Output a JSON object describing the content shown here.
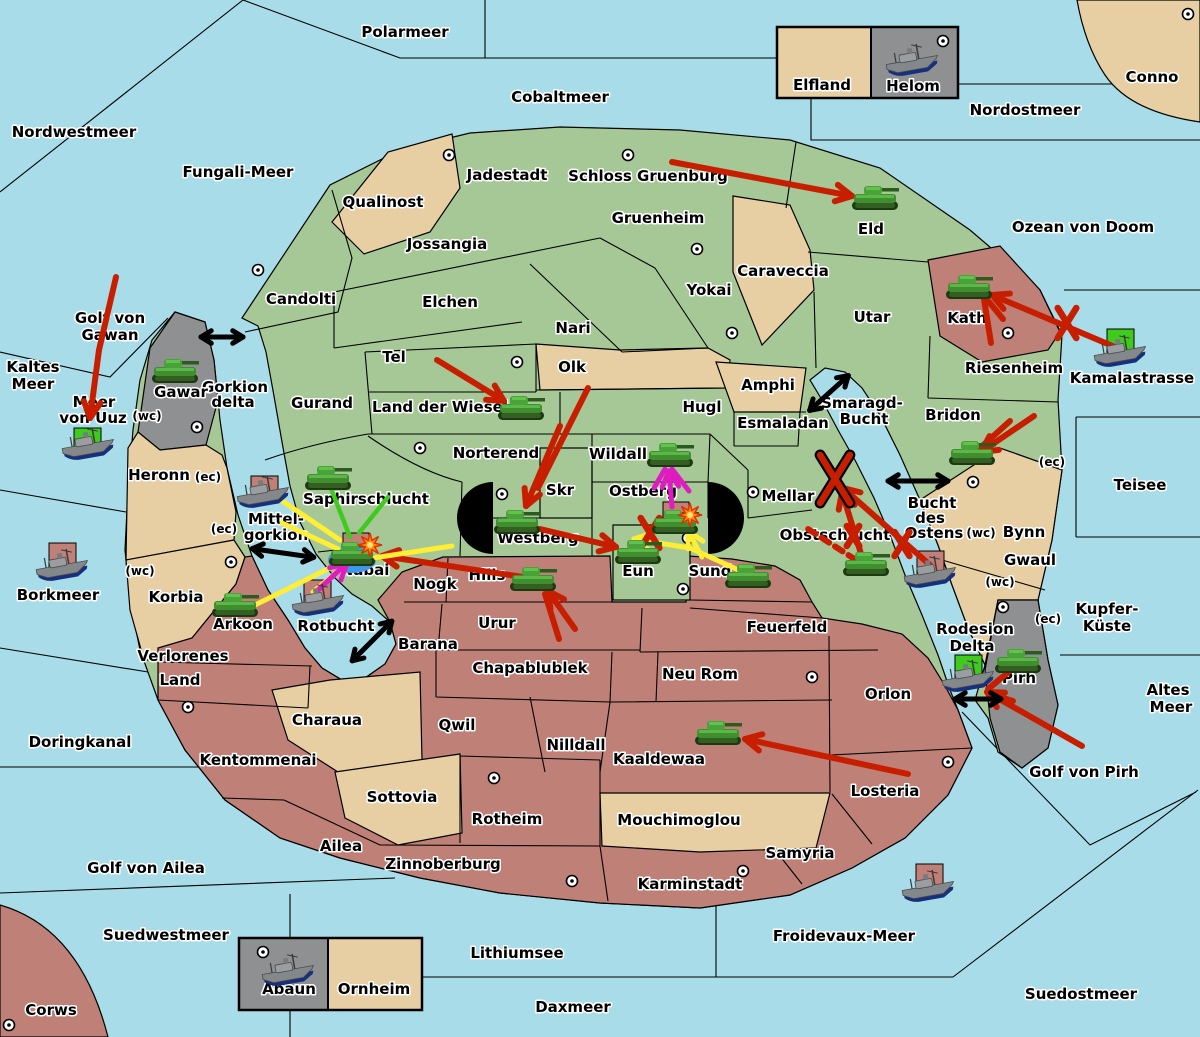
{
  "palette": {
    "sea": "#a8dce8",
    "land_green": "#a6c897",
    "land_tan": "#e7cfa3",
    "land_pink": "#bf8078",
    "land_gray": "#8f9092",
    "arrow_red": "#c81e00",
    "support_yellow": "#ffee33",
    "support_green": "#3ecb1e",
    "convoy_magenta": "#df1cc0",
    "dislodged_blue": "#3e97e8",
    "explosion_orange": "#ff9100",
    "border_black": "#000000"
  },
  "labels": [
    {
      "t": "Polarmeer",
      "x": 405,
      "y": 37
    },
    {
      "t": "Cobaltmeer",
      "x": 560,
      "y": 102
    },
    {
      "t": "Nordostmeer",
      "x": 1025,
      "y": 115
    },
    {
      "t": "Conno",
      "x": 1152,
      "y": 82
    },
    {
      "t": "Ozean von Doom",
      "x": 1083,
      "y": 232
    },
    {
      "t": "Nordwestmeer",
      "x": 74,
      "y": 137
    },
    {
      "t": "Fungali-Meer",
      "x": 238,
      "y": 177
    },
    {
      "t": "Kaltes",
      "x": 33,
      "y": 372
    },
    {
      "t": "Meer",
      "x": 33,
      "y": 389
    },
    {
      "t": "Golf von",
      "x": 110,
      "y": 323
    },
    {
      "t": "Gawan",
      "x": 110,
      "y": 340
    },
    {
      "t": "Meer",
      "x": 94,
      "y": 407
    },
    {
      "t": "von Uuz",
      "x": 93,
      "y": 423
    },
    {
      "t": "Kamalastrasse",
      "x": 1132,
      "y": 383
    },
    {
      "t": "Teisee",
      "x": 1140,
      "y": 490
    },
    {
      "t": "Borkmeer",
      "x": 58,
      "y": 600
    },
    {
      "t": "Doringkanal",
      "x": 80,
      "y": 747
    },
    {
      "t": "Golf von Ailea",
      "x": 146,
      "y": 873
    },
    {
      "t": "Suedwestmeer",
      "x": 166,
      "y": 940
    },
    {
      "t": "Lithiumsee",
      "x": 517,
      "y": 958
    },
    {
      "t": "Daxmeer",
      "x": 573,
      "y": 1012
    },
    {
      "t": "Froidevaux-Meer",
      "x": 844,
      "y": 941
    },
    {
      "t": "Suedostmeer",
      "x": 1081,
      "y": 999
    },
    {
      "t": "Golf von Pirh",
      "x": 1084,
      "y": 777
    },
    {
      "t": "Kupfer-",
      "x": 1107,
      "y": 614
    },
    {
      "t": "Küste",
      "x": 1107,
      "y": 631
    },
    {
      "t": "Altes",
      "x": 1168,
      "y": 695
    },
    {
      "t": "Meer",
      "x": 1171,
      "y": 712
    },
    {
      "t": "Corws",
      "x": 51,
      "y": 1015
    },
    {
      "t": "Smaragd-",
      "x": 862,
      "y": 408
    },
    {
      "t": "Bucht",
      "x": 864,
      "y": 424
    },
    {
      "t": "Bucht",
      "x": 932,
      "y": 508
    },
    {
      "t": "des",
      "x": 930,
      "y": 523
    },
    {
      "t": "Ostens",
      "x": 934,
      "y": 538
    },
    {
      "t": "Mittel-",
      "x": 276,
      "y": 524
    },
    {
      "t": "gorkion",
      "x": 276,
      "y": 540
    },
    {
      "t": "Gorkion",
      "x": 235,
      "y": 392
    },
    {
      "t": "delta",
      "x": 233,
      "y": 407
    },
    {
      "t": "Rotbucht",
      "x": 336,
      "y": 631
    },
    {
      "t": "Qualinost",
      "x": 383,
      "y": 207
    },
    {
      "t": "Jadestadt",
      "x": 507,
      "y": 180
    },
    {
      "t": "Schloss Gruenburg",
      "x": 648,
      "y": 181
    },
    {
      "t": "Gruenheim",
      "x": 658,
      "y": 223
    },
    {
      "t": "Jossangia",
      "x": 447,
      "y": 249
    },
    {
      "t": "Candolti",
      "x": 301,
      "y": 304
    },
    {
      "t": "Elchen",
      "x": 450,
      "y": 307
    },
    {
      "t": "Nari",
      "x": 573,
      "y": 333
    },
    {
      "t": "Yokai",
      "x": 709,
      "y": 295
    },
    {
      "t": "Caraveccia",
      "x": 783,
      "y": 276
    },
    {
      "t": "Eld",
      "x": 871,
      "y": 234
    },
    {
      "t": "Utar",
      "x": 872,
      "y": 322
    },
    {
      "t": "Kath",
      "x": 967,
      "y": 323
    },
    {
      "t": "Riesenheim",
      "x": 1014,
      "y": 373
    },
    {
      "t": "Bridon",
      "x": 953,
      "y": 420
    },
    {
      "t": "Bynn",
      "x": 1024,
      "y": 537
    },
    {
      "t": "Gwaul",
      "x": 1030,
      "y": 565
    },
    {
      "t": "Pirh",
      "x": 1019,
      "y": 683
    },
    {
      "t": "Rodesion",
      "x": 975,
      "y": 634
    },
    {
      "t": "Delta",
      "x": 972,
      "y": 651
    },
    {
      "t": "Gurand",
      "x": 322,
      "y": 408
    },
    {
      "t": "Tel",
      "x": 394,
      "y": 362
    },
    {
      "t": "Land der Wiesel",
      "x": 440,
      "y": 412
    },
    {
      "t": "Olk",
      "x": 572,
      "y": 372
    },
    {
      "t": "Hugl",
      "x": 702,
      "y": 412
    },
    {
      "t": "Amphi",
      "x": 768,
      "y": 390
    },
    {
      "t": "Esmaladan",
      "x": 783,
      "y": 428
    },
    {
      "t": "Norterend",
      "x": 496,
      "y": 458
    },
    {
      "t": "Wildall",
      "x": 618,
      "y": 459
    },
    {
      "t": "Skr",
      "x": 560,
      "y": 495
    },
    {
      "t": "Ostberg",
      "x": 643,
      "y": 496
    },
    {
      "t": "Mellar",
      "x": 788,
      "y": 501
    },
    {
      "t": "Obstschlucht",
      "x": 835,
      "y": 540
    },
    {
      "t": "Westberg",
      "x": 538,
      "y": 543
    },
    {
      "t": "Eun",
      "x": 638,
      "y": 576
    },
    {
      "t": "Sund",
      "x": 710,
      "y": 576
    },
    {
      "t": "Hills",
      "x": 487,
      "y": 580
    },
    {
      "t": "Nogk",
      "x": 435,
      "y": 589
    },
    {
      "t": "Saphirschlucht",
      "x": 366,
      "y": 504
    },
    {
      "t": "Nabai",
      "x": 365,
      "y": 575
    },
    {
      "t": "Urur",
      "x": 497,
      "y": 628
    },
    {
      "t": "Barana",
      "x": 428,
      "y": 649
    },
    {
      "t": "Chapablublek",
      "x": 530,
      "y": 673
    },
    {
      "t": "Neu Rom",
      "x": 700,
      "y": 679
    },
    {
      "t": "Feuerfeld",
      "x": 787,
      "y": 632
    },
    {
      "t": "Qwil",
      "x": 457,
      "y": 730
    },
    {
      "t": "Nilldall",
      "x": 576,
      "y": 750
    },
    {
      "t": "Kaaldewaa",
      "x": 659,
      "y": 764
    },
    {
      "t": "Mouchimoglou",
      "x": 679,
      "y": 825
    },
    {
      "t": "Charaua",
      "x": 327,
      "y": 725
    },
    {
      "t": "Kentommenai",
      "x": 258,
      "y": 765
    },
    {
      "t": "Sottovia",
      "x": 402,
      "y": 802
    },
    {
      "t": "Rotheim",
      "x": 507,
      "y": 824
    },
    {
      "t": "Ailea",
      "x": 341,
      "y": 851
    },
    {
      "t": "Zinnoberburg",
      "x": 443,
      "y": 869
    },
    {
      "t": "Karminstadt",
      "x": 690,
      "y": 889
    },
    {
      "t": "Samyria",
      "x": 800,
      "y": 858
    },
    {
      "t": "Losteria",
      "x": 885,
      "y": 796
    },
    {
      "t": "Orlon",
      "x": 888,
      "y": 699
    },
    {
      "t": "Verlorenes",
      "x": 183,
      "y": 661
    },
    {
      "t": "Land",
      "x": 180,
      "y": 685
    },
    {
      "t": "Arkoon",
      "x": 243,
      "y": 629
    },
    {
      "t": "Korbia",
      "x": 176,
      "y": 602
    },
    {
      "t": "Heronn",
      "x": 159,
      "y": 480
    },
    {
      "t": "Gawar",
      "x": 181,
      "y": 397
    },
    {
      "t": "Elfland",
      "x": 822,
      "y": 90
    },
    {
      "t": "Helom",
      "x": 913,
      "y": 91
    },
    {
      "t": "Abaun",
      "x": 289,
      "y": 994
    },
    {
      "t": "Ornheim",
      "x": 374,
      "y": 994
    },
    {
      "t": "(wc)",
      "x": 147,
      "y": 420,
      "s": 12
    },
    {
      "t": "(ec)",
      "x": 208,
      "y": 481,
      "s": 12
    },
    {
      "t": "(ec)",
      "x": 224,
      "y": 533,
      "s": 12
    },
    {
      "t": "(wc)",
      "x": 140,
      "y": 575,
      "s": 12
    },
    {
      "t": "(ec)",
      "x": 1052,
      "y": 466,
      "s": 12
    },
    {
      "t": "(wc)",
      "x": 981,
      "y": 537,
      "s": 12
    },
    {
      "t": "(wc)",
      "x": 1000,
      "y": 586,
      "s": 12
    },
    {
      "t": "(ec)",
      "x": 1048,
      "y": 623,
      "s": 12
    }
  ],
  "supply_centers": [
    [
      449,
      155
    ],
    [
      628,
      155
    ],
    [
      697,
      249
    ],
    [
      258,
      270
    ],
    [
      517,
      362
    ],
    [
      732,
      333
    ],
    [
      943,
      41
    ],
    [
      1188,
      14
    ],
    [
      197,
      427
    ],
    [
      420,
      448
    ],
    [
      502,
      494
    ],
    [
      688,
      538
    ],
    [
      683,
      589
    ],
    [
      753,
      492
    ],
    [
      973,
      482
    ],
    [
      1008,
      333
    ],
    [
      1003,
      607
    ],
    [
      188,
      707
    ],
    [
      9,
      1025
    ],
    [
      494,
      778
    ],
    [
      572,
      881
    ],
    [
      743,
      871
    ],
    [
      948,
      762
    ],
    [
      263,
      952
    ],
    [
      231,
      562
    ],
    [
      812,
      677
    ]
  ],
  "units": {
    "tanks": [
      {
        "r": "Eld",
        "x": 875,
        "y": 200
      },
      {
        "r": "Kath",
        "x": 969,
        "y": 289
      },
      {
        "r": "Bridon",
        "x": 972,
        "y": 455
      },
      {
        "r": "Gawar",
        "x": 175,
        "y": 373
      },
      {
        "r": "Saphirschlucht",
        "x": 328,
        "y": 480
      },
      {
        "r": "Nabai",
        "x": 352,
        "y": 556
      },
      {
        "r": "Arkoon",
        "x": 235,
        "y": 607
      },
      {
        "r": "Land der Wiesel",
        "x": 521,
        "y": 410
      },
      {
        "r": "Westberg",
        "x": 517,
        "y": 524
      },
      {
        "r": "Hills",
        "x": 533,
        "y": 581
      },
      {
        "r": "Eun",
        "x": 638,
        "y": 554
      },
      {
        "r": "Ostberg",
        "x": 675,
        "y": 524
      },
      {
        "r": "Sund",
        "x": 748,
        "y": 578
      },
      {
        "r": "Wildall",
        "x": 670,
        "y": 457
      },
      {
        "r": "Obstschlucht",
        "x": 866,
        "y": 566
      },
      {
        "r": "Kaaldewaa",
        "x": 718,
        "y": 735
      },
      {
        "r": "Pirh",
        "x": 1018,
        "y": 663
      }
    ],
    "ships": [
      {
        "r": "Helom",
        "x": 912,
        "y": 61
      },
      {
        "r": "Meer von Uuz",
        "x": 88,
        "y": 445,
        "box": [
          74,
          428
        ],
        "bc": "green"
      },
      {
        "r": "Mittelgorkion",
        "x": 263,
        "y": 493,
        "box": [
          251,
          476
        ],
        "bc": "pink"
      },
      {
        "r": "Borkmeer",
        "x": 62,
        "y": 566,
        "box": [
          49,
          543
        ],
        "bc": "pink"
      },
      {
        "r": "Rotbucht",
        "x": 318,
        "y": 601,
        "box": [
          304,
          580
        ],
        "bc": "pink"
      },
      {
        "r": "Bucht des Ostens",
        "x": 930,
        "y": 573,
        "box": [
          917,
          551
        ],
        "bc": "pink"
      },
      {
        "r": "Rodesion Delta",
        "x": 968,
        "y": 677,
        "box": [
          955,
          655
        ],
        "bc": "green"
      },
      {
        "r": "Froidevaux-Meer",
        "x": 928,
        "y": 887,
        "box": [
          916,
          864
        ],
        "bc": "pink"
      },
      {
        "r": "Kamalastrasse",
        "x": 1120,
        "y": 352,
        "box": [
          1107,
          329
        ],
        "bc": "green"
      },
      {
        "r": "Abaun",
        "x": 288,
        "y": 971
      }
    ]
  },
  "dislodged_marker": {
    "x": 352,
    "y": 560,
    "rx": 24,
    "ry": 13
  },
  "explosions": [
    [
      370,
      545
    ],
    [
      690,
      515
    ]
  ],
  "x_marks": [
    {
      "x": 835,
      "y": 479,
      "s": 24,
      "o": 1
    },
    {
      "x": 1067,
      "y": 323,
      "s": 15
    },
    {
      "x": 902,
      "y": 544,
      "s": 12
    },
    {
      "x": 853,
      "y": 536,
      "s": 10
    },
    {
      "x": 650,
      "y": 533,
      "s": 15
    }
  ],
  "double_arrows": [
    {
      "x": 222,
      "y": 337,
      "len": 42,
      "rot": 0
    },
    {
      "x": 283,
      "y": 553,
      "len": 62,
      "rot": 8
    },
    {
      "x": 372,
      "y": 641,
      "len": 56,
      "rot": -45
    },
    {
      "x": 829,
      "y": 393,
      "len": 52,
      "rot": -42
    },
    {
      "x": 918,
      "y": 481,
      "len": 60,
      "rot": 0
    },
    {
      "x": 978,
      "y": 699,
      "len": 46,
      "rot": 0
    }
  ],
  "arrows": [
    {
      "c": "red",
      "p": [
        [
          672,
          162
        ],
        [
          852,
          196
        ]
      ],
      "h": 1
    },
    {
      "c": "red",
      "p": [
        [
          1122,
          350
        ],
        [
          992,
          295
        ]
      ],
      "h": 1
    },
    {
      "c": "red",
      "p": [
        [
          116,
          277
        ],
        [
          99,
          350
        ],
        [
          90,
          418
        ]
      ],
      "h": 1
    },
    {
      "c": "red",
      "p": [
        [
          437,
          360
        ],
        [
          504,
          401
        ]
      ],
      "h": 1
    },
    {
      "c": "red",
      "p": [
        [
          560,
          426
        ],
        [
          526,
          506
        ]
      ],
      "h": 1
    },
    {
      "c": "red",
      "p": [
        [
          588,
          388
        ],
        [
          538,
          488
        ]
      ],
      "h": 0
    },
    {
      "c": "red",
      "p": [
        [
          540,
          529
        ],
        [
          616,
          547
        ]
      ],
      "h": 1
    },
    {
      "c": "red",
      "p": [
        [
          575,
          629
        ],
        [
          548,
          591
        ]
      ],
      "h": 1
    },
    {
      "c": "red",
      "p": [
        [
          559,
          639
        ],
        [
          545,
          594
        ]
      ],
      "h": 0
    },
    {
      "c": "red",
      "p": [
        [
          530,
          578
        ],
        [
          382,
          556
        ]
      ],
      "h": 1
    },
    {
      "c": "red",
      "p": [
        [
          930,
          565
        ],
        [
          843,
          488
        ]
      ],
      "h": 1
    },
    {
      "c": "red",
      "p": [
        [
          862,
          557
        ],
        [
          842,
          492
        ]
      ],
      "h": 1
    },
    {
      "c": "red",
      "p": [
        [
          856,
          560
        ],
        [
          808,
          529
        ]
      ],
      "h": 0,
      "d": 1
    },
    {
      "c": "red",
      "p": [
        [
          1034,
          416
        ],
        [
          981,
          452
        ]
      ],
      "h": 1
    },
    {
      "c": "red",
      "p": [
        [
          1010,
          421
        ],
        [
          979,
          449
        ]
      ],
      "h": 0
    },
    {
      "c": "red",
      "p": [
        [
          1003,
          319
        ],
        [
          985,
          297
        ]
      ],
      "h": 0
    },
    {
      "c": "red",
      "p": [
        [
          991,
          343
        ],
        [
          984,
          299
        ]
      ],
      "h": 0
    },
    {
      "c": "red",
      "p": [
        [
          908,
          774
        ],
        [
          745,
          739
        ]
      ],
      "h": 1
    },
    {
      "c": "red",
      "p": [
        [
          1082,
          746
        ],
        [
          987,
          692
        ]
      ],
      "h": 1
    },
    {
      "c": "red",
      "p": [
        [
          1011,
          670
        ],
        [
          988,
          689
        ]
      ],
      "h": 0
    },
    {
      "c": "red",
      "p": [
        [
          1013,
          701
        ],
        [
          990,
          694
        ]
      ],
      "h": 0
    },
    {
      "c": "yellow",
      "p": [
        [
          272,
          494
        ],
        [
          340,
          540
        ]
      ],
      "h": 0
    },
    {
      "c": "yellow",
      "p": [
        [
          282,
          523
        ],
        [
          338,
          549
        ]
      ],
      "h": 0
    },
    {
      "c": "yellow",
      "p": [
        [
          255,
          605
        ],
        [
          342,
          562
        ]
      ],
      "h": 0
    },
    {
      "c": "yellow",
      "p": [
        [
          313,
          592
        ],
        [
          344,
          566
        ]
      ],
      "h": 0
    },
    {
      "c": "yellow",
      "p": [
        [
          373,
          558
        ],
        [
          452,
          546
        ]
      ],
      "h": 0
    },
    {
      "c": "yellow",
      "p": [
        [
          743,
          572
        ],
        [
          690,
          548
        ],
        [
          634,
          539
        ]
      ],
      "h": 1
    },
    {
      "c": "yellow",
      "p": [
        [
          702,
          557
        ],
        [
          688,
          531
        ]
      ],
      "h": 1
    },
    {
      "c": "green",
      "p": [
        [
          330,
          486
        ],
        [
          350,
          537
        ]
      ],
      "h": 0
    },
    {
      "c": "green",
      "p": [
        [
          388,
          497
        ],
        [
          359,
          533
        ]
      ],
      "h": 0
    },
    {
      "c": "magenta",
      "p": [
        [
          672,
          507
        ],
        [
          669,
          471
        ]
      ],
      "h": 1
    },
    {
      "c": "magenta",
      "p": [
        [
          654,
          488
        ],
        [
          665,
          469
        ]
      ],
      "h": 0
    },
    {
      "c": "magenta",
      "p": [
        [
          689,
          491
        ],
        [
          672,
          469
        ]
      ],
      "h": 0
    },
    {
      "c": "magenta",
      "p": [
        [
          318,
          590
        ],
        [
          347,
          563
        ]
      ],
      "h": 1
    }
  ],
  "legend_boxes": [
    {
      "x": 777,
      "y": 27,
      "w": 181,
      "h": 71,
      "div": 871,
      "left": "tan",
      "right": "gray"
    },
    {
      "x": 239,
      "y": 938,
      "w": 183,
      "h": 72,
      "div": 328,
      "left": "gray",
      "right": "tan"
    }
  ]
}
